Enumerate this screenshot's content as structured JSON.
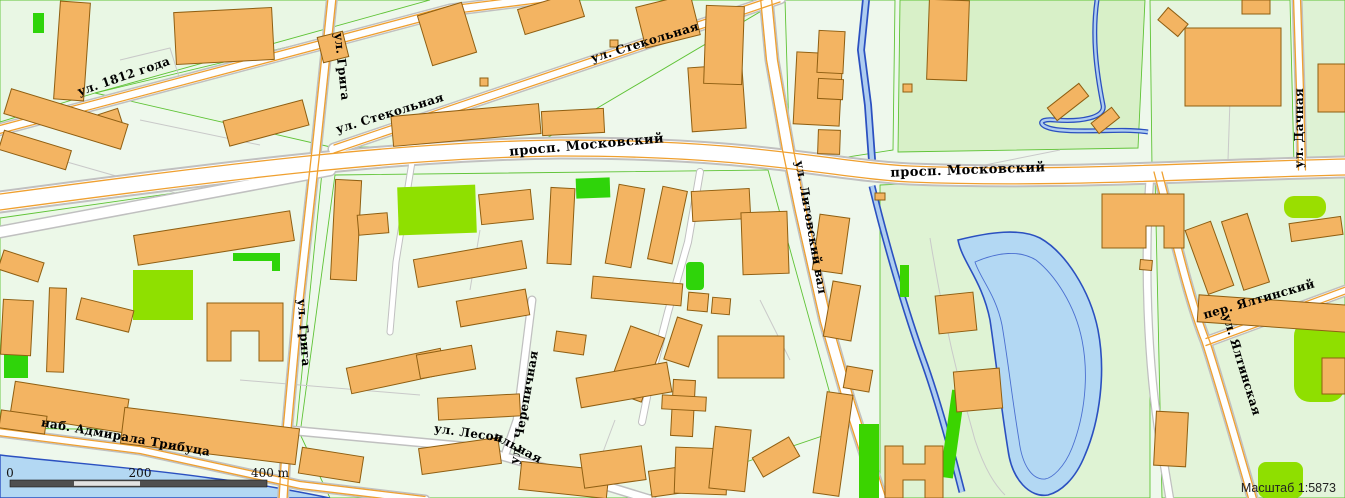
{
  "map": {
    "street_labels": {
      "goda1812": "ул. 1812 года",
      "griga_top": "ул. Грига",
      "griga_mid": "ул. Грига",
      "stekolnaya_west": "ул. Стекольная",
      "stekolnaya_top": "ул. Стекольная",
      "moskovsky_west": "просп. Московский",
      "moskovsky_east": "просп. Московский",
      "litovsky_val": "ул. Литовский вал",
      "dachnaya": "ул. Дачная",
      "yaltinsky_lane": "пер. Ялтинский",
      "yaltinskaya": "ул. Ялтинская",
      "tributsa_emb": "наб. Адмирала Трибуца",
      "lesopilnaya_a": "ул. Лесоп",
      "lesopilnaya_b": "ильная",
      "cherepichnaya": "ул. Черепичная"
    },
    "scale_bar": {
      "zero": "0",
      "two_hundred": "200",
      "four_hundred": "400 m"
    },
    "scale_caption": "Масштаб 1:5873",
    "colors": {
      "land": "#eef8ec",
      "park_block": "#d8f0c8",
      "building_fill": "#f3b462",
      "building_stroke": "#8f5f12",
      "water_fill": "#b3d8f3",
      "water_stroke": "#2b50c0",
      "vivid_green": "#3bd400",
      "chartreuse": "#8fe000",
      "road_fill": "#ffffff",
      "road_casing": "#c0c0c0",
      "major_road_edge": "#efa02f",
      "block_outline": "#5fc336",
      "label_color": "#000000"
    }
  }
}
